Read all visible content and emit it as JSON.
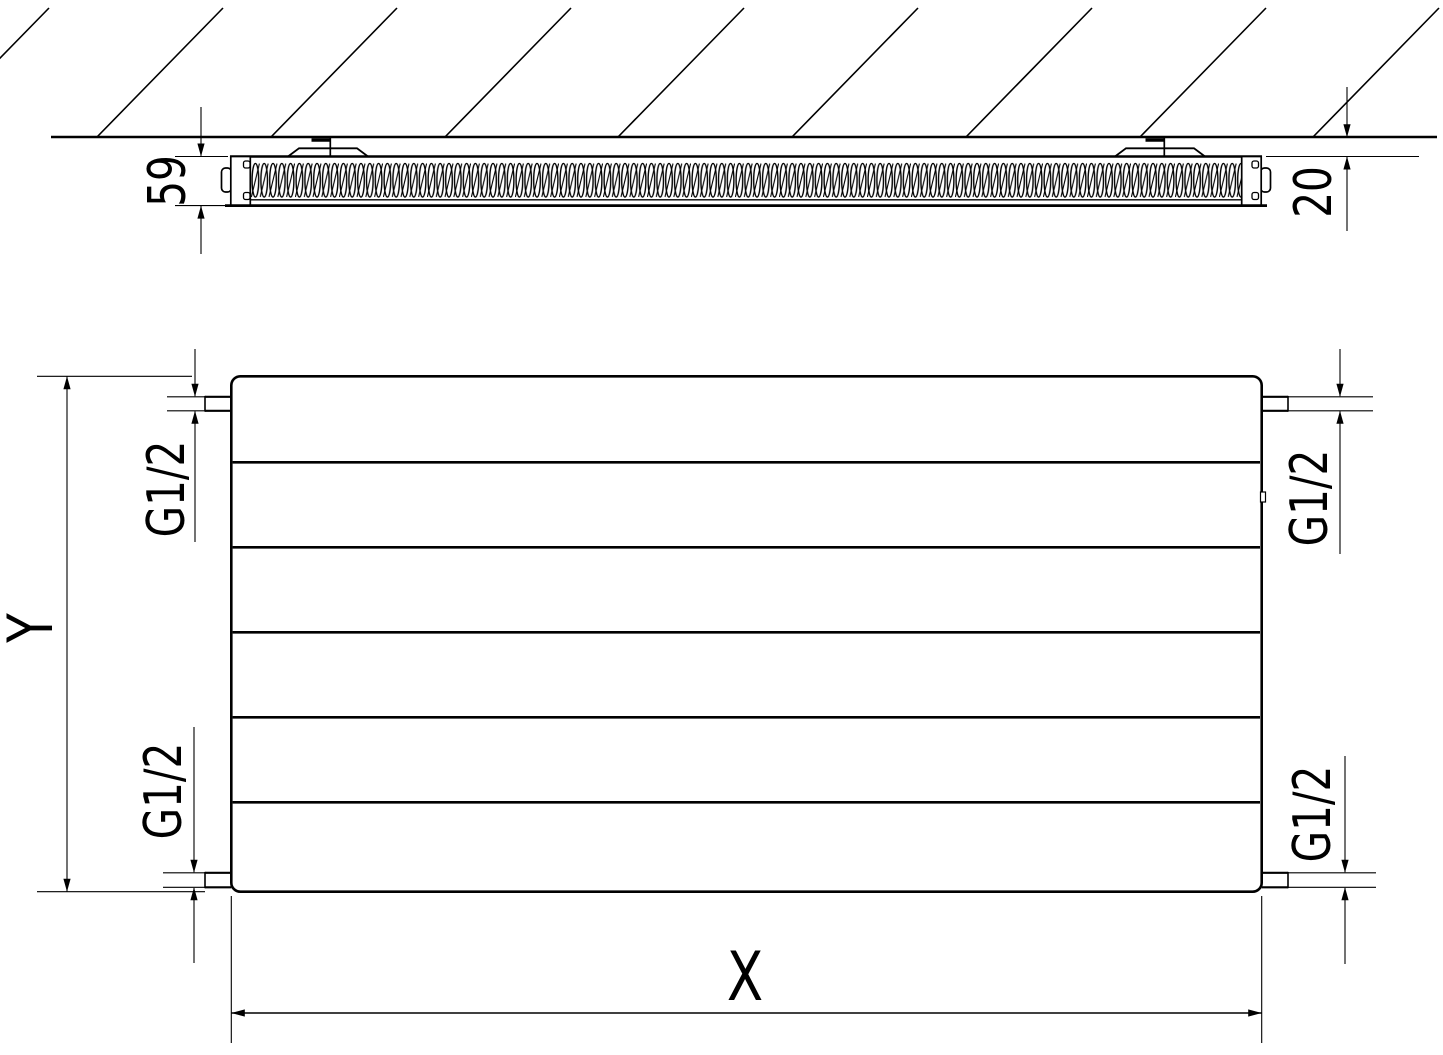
{
  "diagram": {
    "background_color": "#ffffff",
    "line_color": "#000000",
    "top_view": {
      "depth_dimension": "59",
      "wall_clearance_dimension": "20"
    },
    "front_view": {
      "height_dimension_label": "Y",
      "width_dimension_label": "X",
      "connection_top_left": "G1/2",
      "connection_top_right": "G1/2",
      "connection_bottom_left": "G1/2",
      "connection_bottom_right": "G1/2"
    }
  }
}
